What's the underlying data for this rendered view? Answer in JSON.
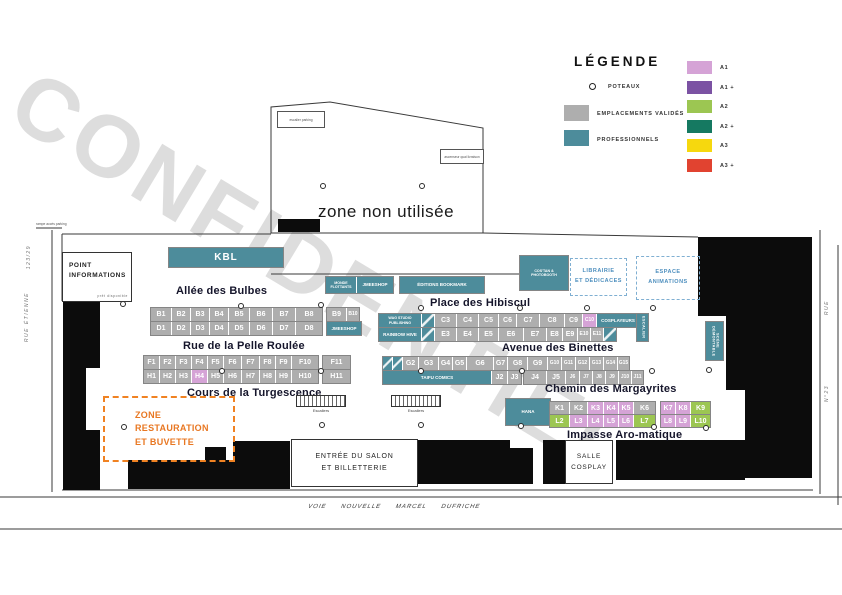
{
  "watermark": "CONFIDENTIEL",
  "legend": {
    "title": "LÉGENDE",
    "poteaux_label": "POTEAUX",
    "validated_label": "EMPLACEMENTS VALIDÉS",
    "validated_color": "#AEAEAE",
    "professional_label": "PROFESSIONNELS",
    "professional_color": "#4D8C9B",
    "categories": [
      {
        "label": "A1",
        "color": "#D5A3D6"
      },
      {
        "label": "A1 +",
        "color": "#7B52A3"
      },
      {
        "label": "A2",
        "color": "#9CC652"
      },
      {
        "label": "A2 +",
        "color": "#157961"
      },
      {
        "label": "A3",
        "color": "#F6D80E"
      },
      {
        "label": "A3 +",
        "color": "#E14330"
      }
    ]
  },
  "areas": {
    "unused_zone": "zone non utilisée",
    "info_point": "POINT INFORMATIONS",
    "info_point_note": "prêt disponible",
    "restaurant_line1": "ZONE RESTAURATION",
    "restaurant_line2": "ET BUVETTE",
    "library_line1": "LIBRAIRIE",
    "library_line2": "ET DÉDICACES",
    "animation_line1": "ESPACE",
    "animation_line2": "ANIMATIONS",
    "entrance_line1": "ENTRÉE DU SALON",
    "entrance_line2": "ET BILLETTERIE",
    "cosplay_line1": "SALLE",
    "cosplay_line2": "COSPLAY",
    "parking_note_top": "escalier parking",
    "parking_note_right": "ascenseur quai livraison",
    "ramp_note": "rampe accès parking",
    "road_bottom": "VOIE NOUVELLE MARCEL DUFRICHE",
    "street_left": "RUE ÉTIENNE",
    "street_left_num": "123/29",
    "street_right": "RUE",
    "street_right_num": "N°23"
  },
  "streets": [
    {
      "label": "Allée des Bulbes",
      "x": 176,
      "y": 285
    },
    {
      "label": "Rue de la Pelle Roulée",
      "x": 183,
      "y": 340
    },
    {
      "label": "Cours de la Turgescence",
      "x": 187,
      "y": 387
    },
    {
      "label": "Place des Hibiscul",
      "x": 430,
      "y": 297
    },
    {
      "label": "Avenue des Binettes",
      "x": 502,
      "y": 342
    },
    {
      "label": "Chemin des Margayrites",
      "x": 545,
      "y": 383
    },
    {
      "label": "Impasse Aro-matique",
      "x": 567,
      "y": 429
    }
  ],
  "escaliers": {
    "label": "Escaliers",
    "items": [
      {
        "x": 296,
        "y": 395
      },
      {
        "x": 391,
        "y": 395
      }
    ]
  },
  "poteaux": {
    "positions": [
      [
        238,
        303
      ],
      [
        318,
        302
      ],
      [
        219,
        368
      ],
      [
        318,
        368
      ],
      [
        320,
        183
      ],
      [
        419,
        183
      ],
      [
        418,
        305
      ],
      [
        517,
        305
      ],
      [
        584,
        305
      ],
      [
        650,
        305
      ],
      [
        418,
        368
      ],
      [
        519,
        368
      ],
      [
        649,
        368
      ],
      [
        518,
        423
      ],
      [
        651,
        424
      ],
      [
        703,
        425
      ],
      [
        121,
        424
      ],
      [
        319,
        422
      ],
      [
        418,
        422
      ],
      [
        120,
        301
      ],
      [
        706,
        367
      ]
    ]
  },
  "booths": {
    "rows": [
      {
        "name": "block-kbl",
        "x": 168,
        "y": 247,
        "h": 19,
        "cells": [
          {
            "label": "KBL",
            "w": 114,
            "type": "pro",
            "cls": "lg"
          }
        ]
      },
      {
        "name": "block-monde-jmeeshop",
        "x": 325,
        "y": 276,
        "h": 16,
        "cells": [
          {
            "label": "MONDE FLOTTANTS",
            "w": 28,
            "type": "pro",
            "cls": "xxs"
          },
          {
            "label": "JMEESHOP",
            "w": 34,
            "type": "pro",
            "cls": "xs"
          }
        ]
      },
      {
        "name": "block-editions-bookmark",
        "x": 399,
        "y": 276,
        "h": 16,
        "cells": [
          {
            "label": "ÉDITIONS BOOKMARK",
            "w": 82,
            "type": "pro",
            "cls": "xs"
          }
        ]
      },
      {
        "name": "block-costan-photobooth",
        "x": 519,
        "y": 255,
        "h": 34,
        "cells": [
          {
            "label": "COS'TAN & PHOTOBOOTH",
            "w": 46,
            "type": "pro",
            "cls": "xxs"
          }
        ]
      },
      {
        "name": "row-b",
        "x": 150,
        "y": 307,
        "h": 13,
        "cells": [
          {
            "label": "B1",
            "w": 20
          },
          {
            "label": "B2",
            "w": 18
          },
          {
            "label": "B3",
            "w": 18
          },
          {
            "label": "B4",
            "w": 18
          },
          {
            "label": "B5",
            "w": 20
          },
          {
            "label": "B6",
            "w": 22
          },
          {
            "label": "B7",
            "w": 22
          },
          {
            "label": "B8",
            "w": 26
          }
        ]
      },
      {
        "name": "row-b-annex",
        "x": 326,
        "y": 307,
        "h": 13,
        "cells": [
          {
            "label": "B9",
            "w": 19
          },
          {
            "label": "B10",
            "w": 12,
            "cls": "sm"
          }
        ]
      },
      {
        "name": "row-d",
        "x": 150,
        "y": 321,
        "h": 13,
        "cells": [
          {
            "label": "D1",
            "w": 20
          },
          {
            "label": "D2",
            "w": 18
          },
          {
            "label": "D3",
            "w": 18
          },
          {
            "label": "D4",
            "w": 18
          },
          {
            "label": "D5",
            "w": 20
          },
          {
            "label": "D6",
            "w": 22
          },
          {
            "label": "D7",
            "w": 22
          },
          {
            "label": "D8",
            "w": 26
          }
        ]
      },
      {
        "name": "row-d-annex",
        "x": 326,
        "y": 321,
        "h": 13,
        "cells": [
          {
            "label": "JMEESHOP",
            "w": 32,
            "type": "pro",
            "cls": "xs"
          }
        ]
      },
      {
        "name": "row-f",
        "x": 143,
        "y": 355,
        "h": 13,
        "cells": [
          {
            "label": "F1",
            "w": 15
          },
          {
            "label": "F2",
            "w": 15
          },
          {
            "label": "F3",
            "w": 15
          },
          {
            "label": "F4",
            "w": 15
          },
          {
            "label": "F5",
            "w": 15
          },
          {
            "label": "F6",
            "w": 17
          },
          {
            "label": "F7",
            "w": 17
          },
          {
            "label": "F8",
            "w": 15
          },
          {
            "label": "F9",
            "w": 15
          },
          {
            "label": "F10",
            "w": 26
          }
        ]
      },
      {
        "name": "row-f-annex",
        "x": 322,
        "y": 355,
        "h": 13,
        "cells": [
          {
            "label": "F11",
            "w": 27
          }
        ]
      },
      {
        "name": "row-h",
        "x": 143,
        "y": 369,
        "h": 13,
        "cells": [
          {
            "label": "H1",
            "w": 15
          },
          {
            "label": "H2",
            "w": 15
          },
          {
            "label": "H3",
            "w": 15
          },
          {
            "label": "H4",
            "w": 15,
            "type": "a1"
          },
          {
            "label": "H5",
            "w": 15
          },
          {
            "label": "H6",
            "w": 17
          },
          {
            "label": "H7",
            "w": 17
          },
          {
            "label": "H8",
            "w": 15
          },
          {
            "label": "H9",
            "w": 15
          },
          {
            "label": "H10",
            "w": 26
          }
        ]
      },
      {
        "name": "row-h-annex",
        "x": 322,
        "y": 369,
        "h": 13,
        "cells": [
          {
            "label": "H11",
            "w": 27
          }
        ]
      },
      {
        "name": "row-c",
        "x": 378,
        "y": 313,
        "h": 13,
        "cells": [
          {
            "label": "WAG STUDIO PUBLISHING",
            "w": 40,
            "type": "pro",
            "cls": "xxs"
          },
          {
            "label": "",
            "w": 12,
            "type": "pro",
            "cls": "diag"
          },
          {
            "label": "C3",
            "w": 21
          },
          {
            "label": "C4",
            "w": 21
          },
          {
            "label": "C5",
            "w": 19
          },
          {
            "label": "C6",
            "w": 17
          },
          {
            "label": "C7",
            "w": 22
          },
          {
            "label": "C8",
            "w": 24
          },
          {
            "label": "C9",
            "w": 17
          },
          {
            "label": "C10",
            "w": 13,
            "type": "a1",
            "cls": "sm"
          },
          {
            "label": "COSPLAYEURS",
            "w": 40,
            "type": "pro",
            "cls": "xs"
          }
        ]
      },
      {
        "name": "block-escalier-vert",
        "x": 636,
        "y": 313,
        "h": 27,
        "cells": [
          {
            "label": "ESCALIER",
            "w": 11,
            "type": "pro",
            "cls": "vert"
          }
        ]
      },
      {
        "name": "row-e",
        "x": 378,
        "y": 327,
        "h": 13,
        "cells": [
          {
            "label": "RAINBOW HIVE",
            "w": 40,
            "type": "pro",
            "cls": "xs"
          },
          {
            "label": "",
            "w": 12,
            "type": "pro",
            "cls": "diag"
          },
          {
            "label": "E3",
            "w": 21
          },
          {
            "label": "E4",
            "w": 21
          },
          {
            "label": "E5",
            "w": 19
          },
          {
            "label": "E6",
            "w": 24
          },
          {
            "label": "E7",
            "w": 22
          },
          {
            "label": "E8",
            "w": 15
          },
          {
            "label": "E9",
            "w": 14
          },
          {
            "label": "E10",
            "w": 12,
            "cls": "sm"
          },
          {
            "label": "E11",
            "w": 12,
            "cls": "sm"
          },
          {
            "label": "",
            "w": 12,
            "type": "pro",
            "cls": "diag"
          }
        ]
      },
      {
        "name": "row-g",
        "x": 382,
        "y": 356,
        "h": 13,
        "cells": [
          {
            "label": "",
            "w": 9,
            "type": "pro",
            "cls": "diag"
          },
          {
            "label": "",
            "w": 9,
            "type": "pro",
            "cls": "diag"
          },
          {
            "label": "G2",
            "w": 15
          },
          {
            "label": "G3",
            "w": 19
          },
          {
            "label": "G4",
            "w": 13
          },
          {
            "label": "G5",
            "w": 13
          },
          {
            "label": "G6",
            "w": 26
          },
          {
            "label": "G7",
            "w": 13
          },
          {
            "label": "G8",
            "w": 19
          },
          {
            "label": "G9",
            "w": 19
          },
          {
            "label": "G10",
            "w": 13,
            "cls": "sm"
          },
          {
            "label": "G11",
            "w": 13,
            "cls": "sm"
          },
          {
            "label": "G12",
            "w": 13,
            "cls": "sm"
          },
          {
            "label": "G13",
            "w": 13,
            "cls": "sm"
          },
          {
            "label": "G14",
            "w": 13,
            "cls": "sm"
          },
          {
            "label": "G15",
            "w": 11,
            "cls": "sm"
          }
        ]
      },
      {
        "name": "row-j-west",
        "x": 382,
        "y": 370,
        "h": 13,
        "cells": [
          {
            "label": "TAIFU COMICS",
            "w": 106,
            "type": "pro",
            "cls": "xs"
          },
          {
            "label": "J2",
            "w": 15
          },
          {
            "label": "J3",
            "w": 13
          }
        ]
      },
      {
        "name": "row-j-east",
        "x": 523,
        "y": 370,
        "h": 13,
        "cells": [
          {
            "label": "J4",
            "w": 22
          },
          {
            "label": "J5",
            "w": 18
          },
          {
            "label": "J6",
            "w": 13,
            "cls": "sm"
          },
          {
            "label": "J7",
            "w": 12,
            "cls": "sm"
          },
          {
            "label": "J8",
            "w": 12,
            "cls": "sm"
          },
          {
            "label": "J9",
            "w": 12,
            "cls": "sm"
          },
          {
            "label": "J10",
            "w": 12,
            "cls": "sm"
          },
          {
            "label": "J11",
            "w": 11,
            "cls": "sm"
          }
        ]
      },
      {
        "name": "block-hana",
        "x": 505,
        "y": 398,
        "h": 26,
        "cells": [
          {
            "label": "HANA",
            "w": 42,
            "type": "pro",
            "cls": "xs"
          }
        ]
      },
      {
        "name": "row-k-west",
        "x": 549,
        "y": 401,
        "h": 12,
        "cells": [
          {
            "label": "K1",
            "w": 19
          },
          {
            "label": "K2",
            "w": 17
          },
          {
            "label": "K3",
            "w": 15,
            "type": "a1"
          },
          {
            "label": "K4",
            "w": 14,
            "type": "a1"
          },
          {
            "label": "K5",
            "w": 14,
            "type": "a1"
          },
          {
            "label": "K6",
            "w": 21
          }
        ]
      },
      {
        "name": "row-k-east",
        "x": 660,
        "y": 401,
        "h": 12,
        "cells": [
          {
            "label": "K7",
            "w": 14,
            "type": "a1"
          },
          {
            "label": "K8",
            "w": 14,
            "type": "a1"
          },
          {
            "label": "K9",
            "w": 19,
            "type": "a2"
          }
        ]
      },
      {
        "name": "row-l-west",
        "x": 549,
        "y": 414,
        "h": 12,
        "cells": [
          {
            "label": "L2",
            "w": 19,
            "type": "a2"
          },
          {
            "label": "L3",
            "w": 17,
            "type": "a1"
          },
          {
            "label": "L4",
            "w": 15,
            "type": "a1"
          },
          {
            "label": "L5",
            "w": 14,
            "type": "a1"
          },
          {
            "label": "L6",
            "w": 14,
            "type": "a1"
          },
          {
            "label": "L7",
            "w": 21,
            "type": "a2"
          }
        ]
      },
      {
        "name": "row-l-east",
        "x": 660,
        "y": 414,
        "h": 12,
        "cells": [
          {
            "label": "L8",
            "w": 14,
            "type": "a1"
          },
          {
            "label": "L9",
            "w": 14,
            "type": "a1"
          },
          {
            "label": "L10",
            "w": 19,
            "type": "a2"
          }
        ]
      },
      {
        "name": "block-scene",
        "x": 705,
        "y": 321,
        "h": 38,
        "cells": [
          {
            "label": "SCÈNE DÉMONTABLE",
            "w": 17,
            "type": "pro",
            "cls": "vert"
          }
        ]
      }
    ]
  }
}
